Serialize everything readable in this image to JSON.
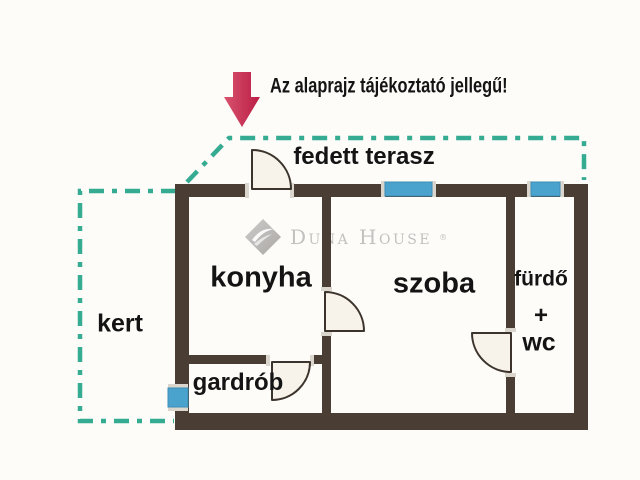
{
  "notice": {
    "text": "Az alaprajz tájékoztató jellegű!",
    "arrow_icon": "down-arrow"
  },
  "watermark": {
    "brand": "Duna House",
    "reg": "®",
    "logo_icon": "duna-house-diamond"
  },
  "rooms": {
    "terrace": "fedett terasz",
    "garden": "kert",
    "kitchen": "konyha",
    "living_room": "szoba",
    "bathroom_line1": "fürdő",
    "bathroom_line2": "+",
    "bathroom_line3": "wc",
    "wardrobe": "gardrób"
  },
  "colors": {
    "wall": "#4a3e34",
    "window": "#4aa3cd",
    "outdoor_dash": "#35ab92",
    "arrow": "#cc2c51",
    "arrow_light": "#d8536d",
    "arrow_dark": "#bb1d45",
    "door_fill": "#f8f3ea",
    "door_stroke": "#3c342c",
    "text": "#141414",
    "watermark": "#c3c1c0",
    "background": "#fdfcf9"
  }
}
